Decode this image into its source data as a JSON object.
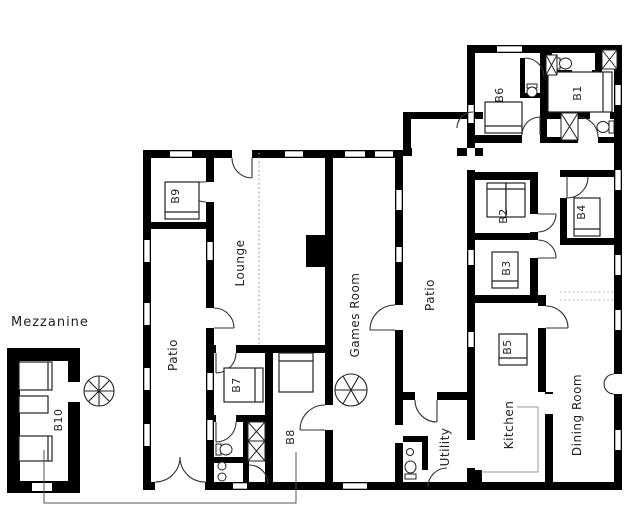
{
  "floor_plan": {
    "labels": {
      "mezzanine": "Mezzanine",
      "lounge": "Lounge",
      "patio_left": "Patio",
      "patio_right": "Patio",
      "games_room": "Games Room",
      "utility": "Utility",
      "kitchen": "Kitchen",
      "dining_room": "Dining Room",
      "b1": "B1",
      "b2": "B2",
      "b3": "B3",
      "b4": "B4",
      "b5": "B5",
      "b6": "B6",
      "b7": "B7",
      "b8": "B8",
      "b9": "B9",
      "b10": "B10"
    },
    "colors": {
      "wall": "#000000",
      "background": "#ffffff",
      "detail_line": "#333333",
      "dotted_line": "#999999",
      "counter_line": "#999999"
    }
  }
}
